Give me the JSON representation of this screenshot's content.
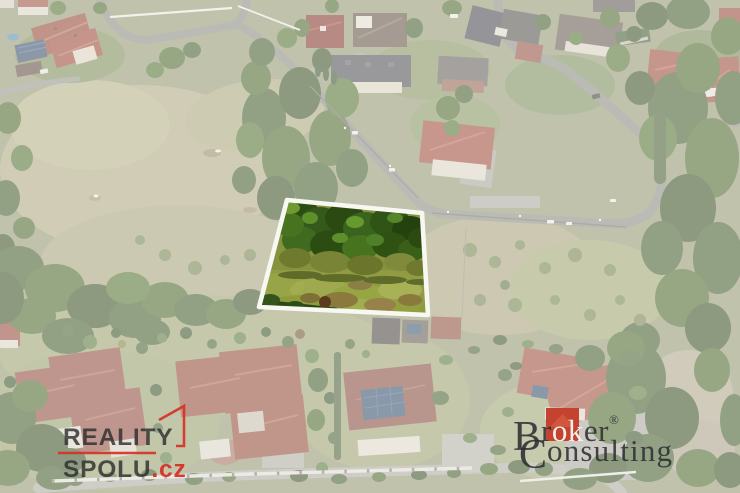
{
  "colors": {
    "accent_red": "#d63226",
    "broker_red": "#c4432e",
    "broker_red_light": "#d2563f",
    "parcel_outline": "#f8f8f3",
    "wash_overlay": "#ffffff"
  },
  "parcel": {
    "points": "287,200 422,213 428,315 259,307",
    "description": "highlighted land plot with forest and meadow"
  },
  "logos": {
    "reality_spolu": {
      "line1": "REALITY",
      "line2": "SPOLU",
      "tld": ".cz"
    },
    "broker_consulting": {
      "initial_b": "B",
      "r1": "r",
      "ok": "ok",
      "er": "er",
      "registered": "®",
      "initial_c": "C",
      "onsulting": "onsulting"
    }
  }
}
